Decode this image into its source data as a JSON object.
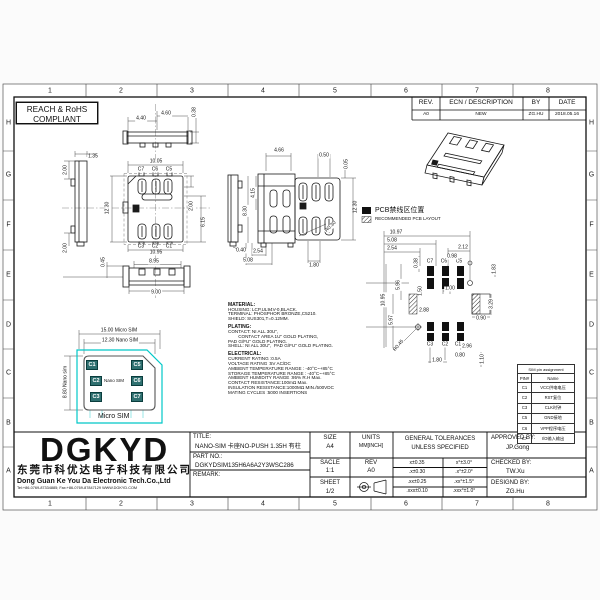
{
  "frame": {
    "columns": [
      "1",
      "2",
      "3",
      "4",
      "5",
      "6",
      "7",
      "8"
    ],
    "rows": [
      "H",
      "G",
      "F",
      "E",
      "D",
      "C",
      "B",
      "A"
    ]
  },
  "compliance": {
    "line1": "REACH & RoHS",
    "line2": "COMPLIANT"
  },
  "rev_table": {
    "headers": [
      "REV.",
      "ECN / DESCRIPTION",
      "BY",
      "DATE"
    ],
    "rows": [
      [
        "A0",
        "NEW",
        "ZG.HU",
        "2018.05.16"
      ]
    ]
  },
  "legend": {
    "item1": "PCB禁线区位置",
    "item2": "RECOMMENDED PCB LAYOUT"
  },
  "material_notes": [
    "MATERIAL:",
    "HOUSING: LCP,UL94V-0,BLACK.",
    "TERMINAL: PHOSPHOR BRONZE,C5210.",
    "SHIELD: SUS301,T=0.12MM.",
    "PLATING:",
    "CONTACT: NI ALL 30U\",",
    "        CONTACT AREA 1U\" GOLD PLATING,",
    "PAD G/FU\" GOLD PLATING.",
    "SHELL: NI ALL 30U\",  PAD G/FU\" GOLD PLATING.",
    "ELECTRICAL:",
    "CURRENT RATING :0.5A",
    "VOLTAGE RATING :5V AC/DC",
    "AMBIENT TEMPERATURE RANGE : -40°C~+85°C",
    "STORAGE TEMPERATURE RANGE : -40°C~+85°C",
    "AMBIENT HUMIDITY RANGE :95% R.H Max.",
    "CONTACT RESISTANCE:100mΩ Max.",
    "INSULATION RESISTANCE:1000MΩ MIN./500VDC",
    "MATING CYCLES :5000 INSERTIONS"
  ],
  "sim_card": {
    "micro_label": "Micro SIM",
    "nano_label": "Nano SIM",
    "pads": [
      "C1",
      "C5",
      "C2",
      "C6",
      "C3",
      "C7"
    ],
    "pad_color": "#2f7070",
    "outline_color": "#00c8c8"
  },
  "pin_table": {
    "title": "SIM pin assignment",
    "headers": [
      "PIN#",
      "Name"
    ],
    "rows": [
      [
        "C1",
        "VCC供电电压"
      ],
      [
        "C2",
        "RST复位"
      ],
      [
        "C3",
        "CLK时钟"
      ],
      [
        "C5",
        "GND接地"
      ],
      [
        "C6",
        "VPP程序电压"
      ],
      [
        "C7",
        "I/O输入输出"
      ]
    ]
  },
  "annotations": [
    {
      "t": "4.40",
      "x": 141,
      "y": 119
    },
    {
      "t": "4.60",
      "x": 166,
      "y": 114
    },
    {
      "t": "0.38",
      "x": 195,
      "y": 112,
      "r": -90
    },
    {
      "t": "2.00",
      "x": 66,
      "y": 170,
      "r": -90
    },
    {
      "t": "1.35",
      "x": 93,
      "y": 157
    },
    {
      "t": "2.00",
      "x": 66,
      "y": 248,
      "r": -90
    },
    {
      "t": "10.05",
      "x": 156,
      "y": 162
    },
    {
      "t": "C7",
      "x": 141,
      "y": 170
    },
    {
      "t": "C6",
      "x": 155,
      "y": 170
    },
    {
      "t": "C5",
      "x": 169,
      "y": 170
    },
    {
      "t": "12.30",
      "x": 108,
      "y": 208,
      "r": -90
    },
    {
      "t": "2.00",
      "x": 192,
      "y": 206,
      "r": -90
    },
    {
      "t": "6.15",
      "x": 204,
      "y": 222,
      "r": -90
    },
    {
      "t": "C3",
      "x": 141,
      "y": 247
    },
    {
      "t": "C2",
      "x": 155,
      "y": 247
    },
    {
      "t": "C1",
      "x": 169,
      "y": 247
    },
    {
      "t": "10.95",
      "x": 156,
      "y": 253
    },
    {
      "t": "0.45",
      "x": 104,
      "y": 262,
      "r": -90
    },
    {
      "t": "8.95",
      "x": 154,
      "y": 262
    },
    {
      "t": "9.00",
      "x": 156,
      "y": 293
    },
    {
      "t": "0.40",
      "x": 241,
      "y": 251
    },
    {
      "t": "4.66",
      "x": 279,
      "y": 151
    },
    {
      "t": "4.15",
      "x": 254,
      "y": 193,
      "r": -90
    },
    {
      "t": "8.30",
      "x": 246,
      "y": 211,
      "r": -90
    },
    {
      "t": "2.54",
      "x": 258,
      "y": 252
    },
    {
      "t": "5.08",
      "x": 248,
      "y": 261
    },
    {
      "t": "0.50",
      "x": 324,
      "y": 156
    },
    {
      "t": "0.05",
      "x": 347,
      "y": 164,
      "r": -90
    },
    {
      "t": "12.30",
      "x": 356,
      "y": 207,
      "r": -90
    },
    {
      "t": "R0.30",
      "x": 331,
      "y": 227,
      "r": -45
    },
    {
      "t": "1.80",
      "x": 314,
      "y": 266
    },
    {
      "t": "10.97",
      "x": 396,
      "y": 233
    },
    {
      "t": "5.08",
      "x": 392,
      "y": 241
    },
    {
      "t": "2.54",
      "x": 392,
      "y": 249
    },
    {
      "t": "2.12",
      "x": 463,
      "y": 248
    },
    {
      "t": "0.38",
      "x": 417,
      "y": 263,
      "r": -90
    },
    {
      "t": "C7",
      "x": 430,
      "y": 262
    },
    {
      "t": "C6",
      "x": 444,
      "y": 262
    },
    {
      "t": "C5",
      "x": 459,
      "y": 262
    },
    {
      "t": "0.98",
      "x": 452,
      "y": 257
    },
    {
      "t": "1.83",
      "x": 495,
      "y": 269,
      "r": -90
    },
    {
      "t": "5.96",
      "x": 399,
      "y": 285,
      "r": -90
    },
    {
      "t": "1.50",
      "x": 421,
      "y": 291,
      "r": -90
    },
    {
      "t": "1.00",
      "x": 450,
      "y": 289
    },
    {
      "t": "10.95",
      "x": 384,
      "y": 300,
      "r": -90
    },
    {
      "t": "2.88",
      "x": 424,
      "y": 311
    },
    {
      "t": "5.97",
      "x": 392,
      "y": 320,
      "r": -90
    },
    {
      "t": "3.29",
      "x": 492,
      "y": 304,
      "r": -90
    },
    {
      "t": "0.90",
      "x": 481,
      "y": 319
    },
    {
      "t": "R0.45",
      "x": 399,
      "y": 346,
      "r": -50
    },
    {
      "t": "C3",
      "x": 430,
      "y": 345
    },
    {
      "t": "C2",
      "x": 445,
      "y": 345
    },
    {
      "t": "C1",
      "x": 458,
      "y": 345
    },
    {
      "t": "2.96",
      "x": 467,
      "y": 347
    },
    {
      "t": "0.80",
      "x": 460,
      "y": 356
    },
    {
      "t": "1.80",
      "x": 437,
      "y": 361
    },
    {
      "t": "1.10",
      "x": 483,
      "y": 359,
      "r": -90
    },
    {
      "t": "15.00 Micro SIM",
      "x": 119,
      "y": 331
    },
    {
      "t": "12.30 Nano SIM",
      "x": 120,
      "y": 341
    },
    {
      "t": "8.80 Nano sim",
      "x": 66,
      "y": 382,
      "r": -90
    }
  ],
  "title_block": {
    "logo": "DGKYD",
    "company_cn": "东莞市科优达电子科技有限公司",
    "company_en": "Dong Guan Ke You Da Electronic Tech.Co.,Ltd",
    "contact": "Tel:+86-0769-87334885; Fax:+86-0769-87847129  WWW.DGKYD.COM",
    "title_label": "TITLE:",
    "title_value": "NANO-SIM 卡座NO-PUSH 1.35H 有柱",
    "part_label": "PART NO.:",
    "part_value": "DGKYDSIM135H6A6A2Y3WSC286",
    "remark_label": "REMARK:",
    "size_label": "SIZE",
    "size_value": "A4",
    "scale_label": "SACLE",
    "scale_value": "1:1",
    "sheet_label": "SHEET",
    "sheet_value": "1/2",
    "units_label": "UNITS",
    "units_value": "MM[INCH]",
    "rev_label": "REV",
    "rev_value": "A0",
    "tol_title1": "GENERAL TOLERANCES",
    "tol_title2": "UNLESS SPECIFIED",
    "tolerances": [
      [
        "x±0.35",
        "x°±3.0°"
      ],
      [
        ".x±0.30",
        ".x°±2.0°"
      ],
      [
        ".xx±0.25",
        ".xx°±1.5°"
      ],
      [
        ".xxx±0.10",
        ".xxx°±1.0°"
      ]
    ],
    "approved_label": "APPROVED BY:",
    "approved_value": "JP.Gong",
    "checked_label": "CHECKED BY:",
    "checked_value": "TW.Xu",
    "designed_label": "DESIGND BY:",
    "designed_value": "ZG.Hu"
  }
}
